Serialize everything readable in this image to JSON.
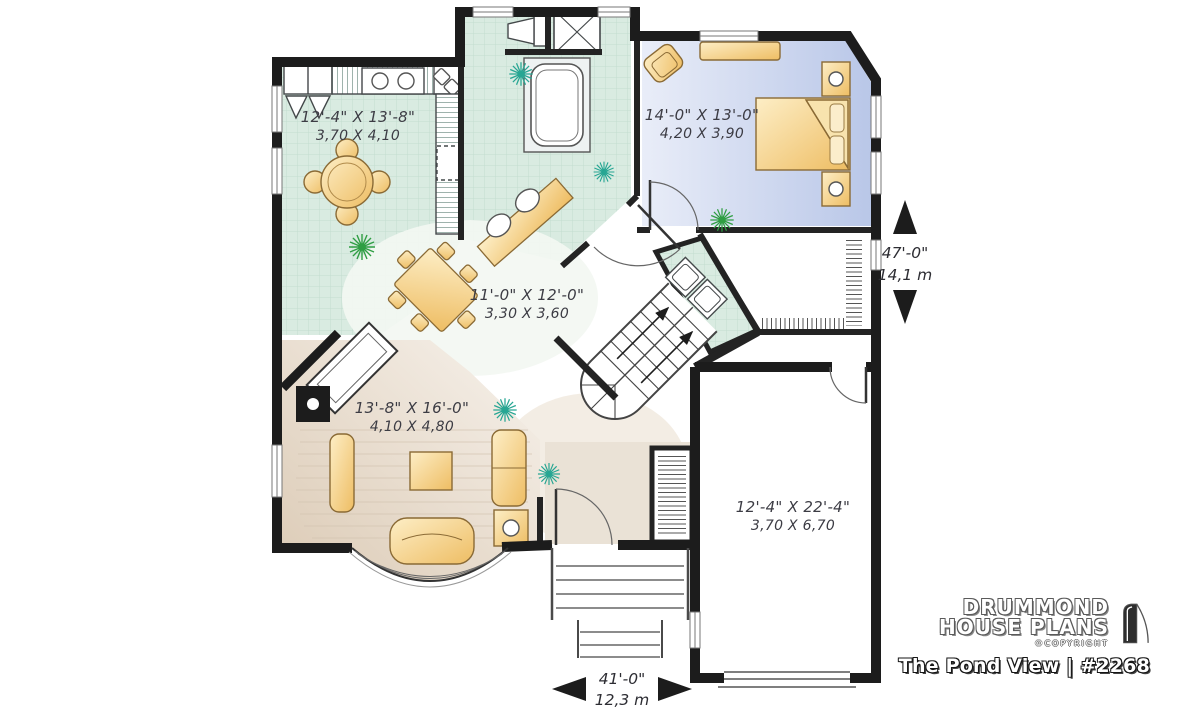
{
  "logo": {
    "brand_line1": "DRUMMOND",
    "brand_line2": "HOUSE PLANS",
    "copyright": "©COPYRIGHT",
    "title": "The Pond View | #2268"
  },
  "rooms": {
    "kitchen": {
      "imperial": "12'-4\" X 13'-8\"",
      "metric": "3,70 X 4,10"
    },
    "bedroom": {
      "imperial": "14'-0\" X 13'-0\"",
      "metric": "4,20 X 3,90"
    },
    "dining": {
      "imperial": "11'-0\" X 12'-0\"",
      "metric": "3,30 X 3,60"
    },
    "living": {
      "imperial": "13'-8\" X 16'-0\"",
      "metric": "4,10 X 4,80"
    },
    "garage": {
      "imperial": "12'-4\" X 22'-4\"",
      "metric": "3,70 X 6,70"
    }
  },
  "overall_dimensions": {
    "depth": {
      "imperial": "47'-0\"",
      "metric": "14,1 m"
    },
    "width": {
      "imperial": "41'-0\"",
      "metric": "12,3 m"
    }
  },
  "colors": {
    "wall": "#1c1c1c",
    "tile_floor": "#d9ebe1",
    "bedroom_floor": "#c2cee9",
    "living_floor": "#ddcebc",
    "furniture": "#f3cd84",
    "plant_teal": "#27a693",
    "plant_green": "#2f9e43",
    "label_text": "#3c3c44"
  }
}
